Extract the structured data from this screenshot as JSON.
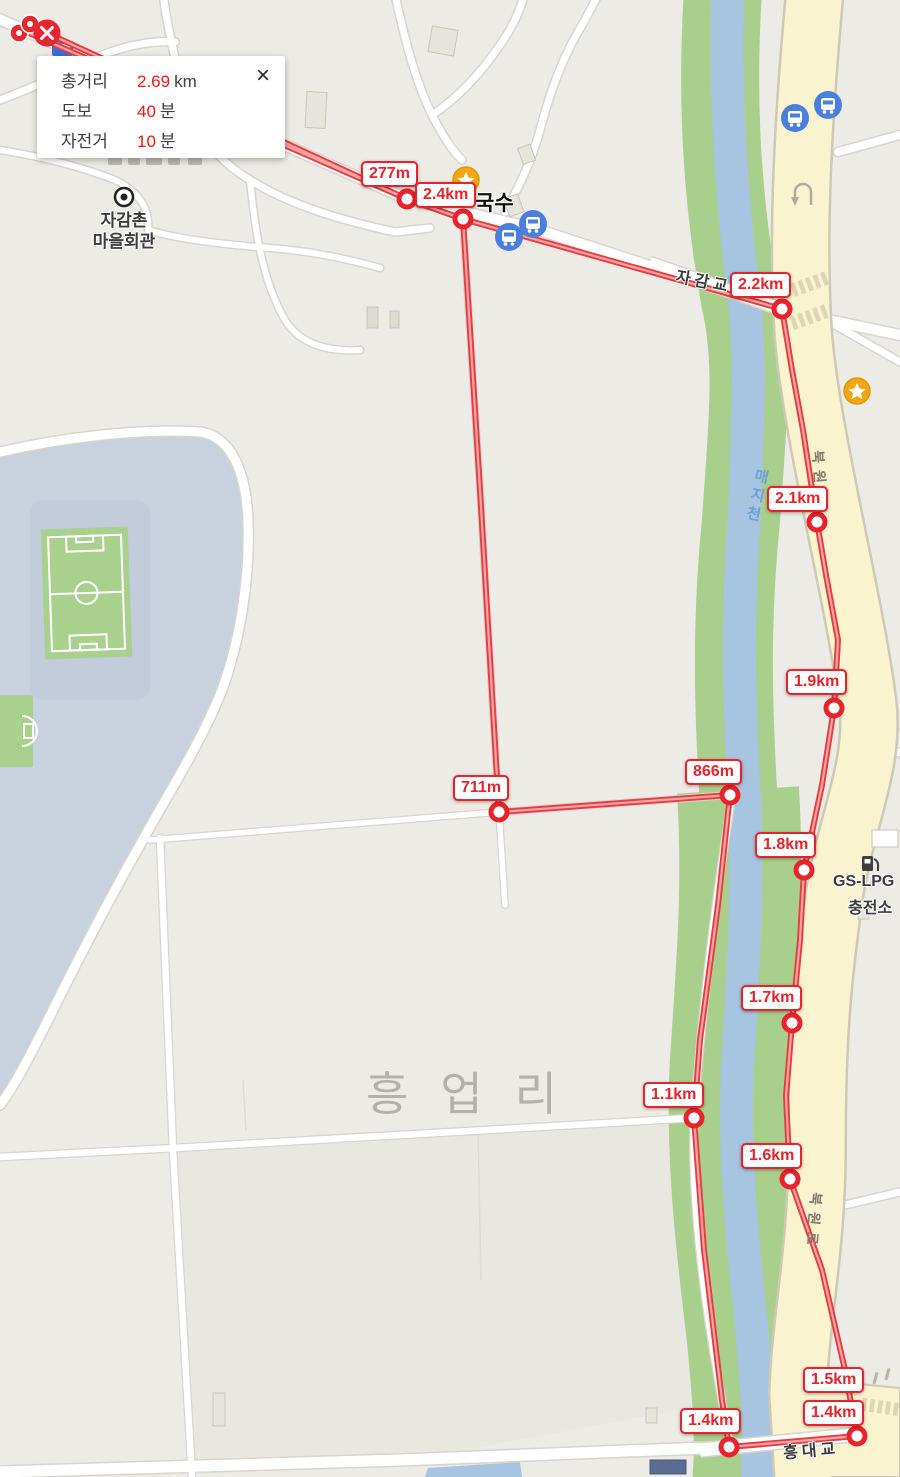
{
  "popup": {
    "rows": [
      {
        "label": "총거리",
        "value": "2.69",
        "unit": "km"
      },
      {
        "label": "도보",
        "value": "40",
        "unit": "분"
      },
      {
        "label": "자전거",
        "value": "10",
        "unit": "분"
      }
    ],
    "close": "×"
  },
  "route": {
    "total_distance_km": "2.69",
    "walk_minutes": "40",
    "bicycle_minutes": "10",
    "distance_labels": [
      {
        "text": "277m"
      },
      {
        "text": "2.4km"
      },
      {
        "text": "2.2km"
      },
      {
        "text": "2.1km"
      },
      {
        "text": "1.9km"
      },
      {
        "text": "1.8km"
      },
      {
        "text": "866m"
      },
      {
        "text": "711m"
      },
      {
        "text": "1.7km"
      },
      {
        "text": "1.1km"
      },
      {
        "text": "1.6km"
      },
      {
        "text": "1.5km"
      },
      {
        "text": "1.4km"
      },
      {
        "text": "1.4km"
      }
    ]
  },
  "places": {
    "village_hall_line1": "자감촌",
    "village_hall_line2": "마을회관",
    "noodle_shop": "국수",
    "district": "흥업리",
    "river_name": "매지천",
    "road_name": "북원로",
    "bridge_top": "자감교",
    "bridge_bottom": "흥대교",
    "gas_station_line1": "GS-LPG",
    "gas_station_line2": "충전소"
  },
  "icons": {
    "bus_stop": "bus-stop-icon",
    "poi_star": "star-poi-icon",
    "village_hall": "bullseye-icon",
    "gas_pump": "fuel-pump-icon",
    "u_turn": "u-turn-road-marking"
  },
  "colors": {
    "route_red": "#e73c41",
    "route_core": "#f9a5a3",
    "marker_ring": "#e8232b",
    "road_yellow": "#f9f3d0",
    "river_blue": "#a7c4e1",
    "bank_green": "#a8cf8c",
    "campus_bluegray": "#c8d2de",
    "bus_blue": "#4a7fdd",
    "star_orange": "#f0a713"
  }
}
